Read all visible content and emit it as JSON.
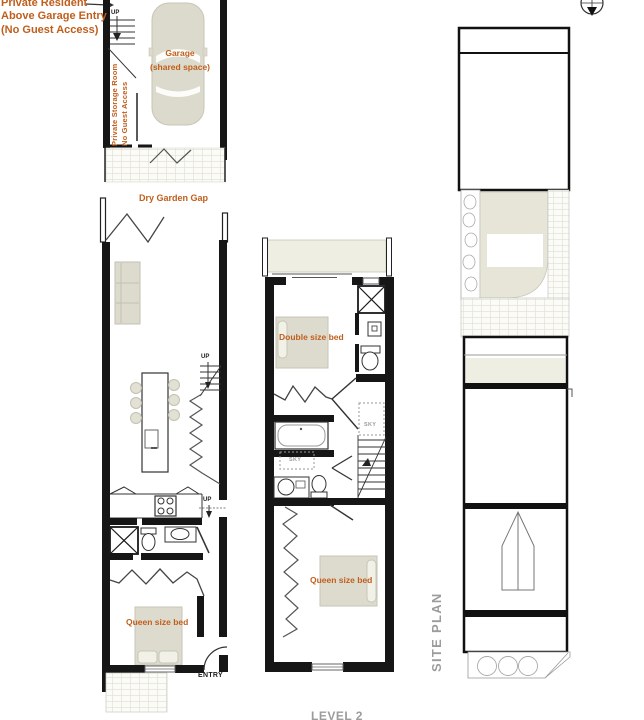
{
  "colors": {
    "accent_orange": "#C05E1C",
    "wall_black": "#161616",
    "furniture_beige": "#DCDBCE",
    "terrace_beige": "#EFEEE3",
    "gray_text": "#9C9C9C"
  },
  "garage_entry_note": {
    "line1": "Private Resident",
    "line2": "Above Garage Entry",
    "line3": "(No Guest Access)"
  },
  "garage_plan": {
    "up": "UP",
    "storage_line1": "Private Storage Room",
    "storage_line2": "No Guest Access",
    "garage_line1": "Garage",
    "garage_line2": "(shared space)"
  },
  "living_plan": {
    "dry_garden_gap": "Dry Garden Gap",
    "up_stairs": "UP",
    "up_kitchen": "UP",
    "queen_bed": "Queen size bed",
    "entry": "ENTRY"
  },
  "bedroom_plan": {
    "double_bed": "Double size bed",
    "queen_bed": "Queen size bed",
    "sky_bath": "SKY",
    "sky_stairs": "SKY",
    "level_label": "LEVEL 2"
  },
  "site_plan": {
    "title": "SITE PLAN"
  }
}
